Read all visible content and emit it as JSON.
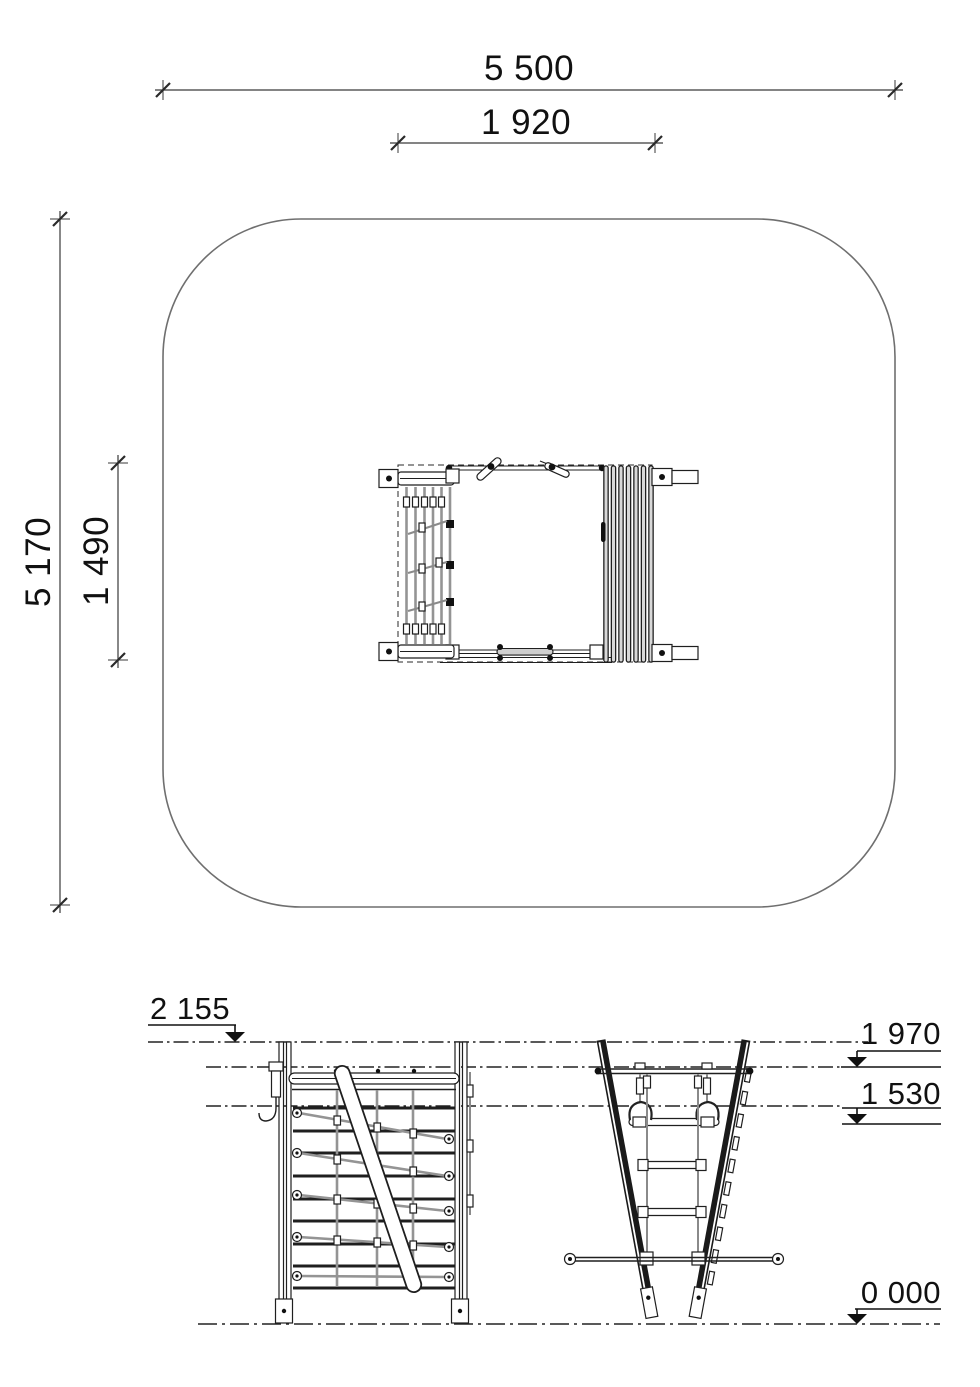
{
  "plan": {
    "overall_width": "5 500",
    "equipment_width": "1 920",
    "overall_depth": "5 170",
    "equipment_depth": "1 490"
  },
  "elevation": {
    "level_top": "2 155",
    "level_bar": "1 970",
    "level_grip": "1 530",
    "level_ground": "0 000"
  },
  "colors": {
    "line": "#1f1f1f",
    "rope_gray": "#949494",
    "boundary_gray": "#6f6f6f",
    "background": "#ffffff"
  }
}
